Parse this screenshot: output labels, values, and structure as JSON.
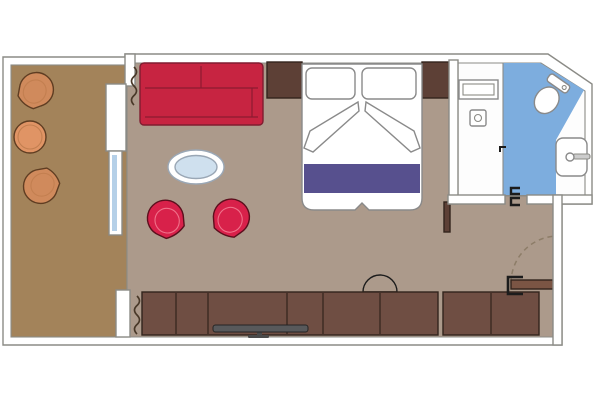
{
  "colors": {
    "background": "#ffffff",
    "wall_fill": "#ffffff",
    "wall_outline": "#8b8b86",
    "balcony_floor": "#a3835a",
    "cabin_floor": "#ac9a8b",
    "bathroom_floor_white": "#fdfdfd",
    "bathroom_floor_blue": "#7dadde",
    "glass_blue": "#b5d0e8",
    "sofa_red": "#c72441",
    "chair_red": "#d8214a",
    "stool_red": "#d8214a",
    "runner_purple": "#57508e",
    "wood_dark": "#5d4036",
    "wood_cabinet": "#6f4e43",
    "door_wood": "#7b5544",
    "balcony_chair_rim": "#d08a5c",
    "balcony_chair_seat": "#e7a377",
    "balcony_table": "#e09465",
    "oval_table_top": "#cfe0ee",
    "tv_gray": "#58595b",
    "tv_stand_gray": "#4a4a4a",
    "fixture_white": "#ffffff",
    "bracket_black": "#1c1c1c"
  },
  "scene": {
    "type": "cabin-floor-plan",
    "rooms": [
      {
        "name": "balcony",
        "items": [
          "tub-armchair",
          "tub-armchair",
          "round-table"
        ]
      },
      {
        "name": "living-area",
        "items": [
          "sofa",
          "oval-coffee-table",
          "swivel-chair",
          "swivel-chair",
          "tv-cabinet",
          "tv",
          "stool",
          "curtain",
          "curtain",
          "sliding-glass-door"
        ]
      },
      {
        "name": "sleeping-area",
        "items": [
          "double-bed",
          "pillow",
          "pillow",
          "folded-sheets",
          "bed-runner",
          "nightstand",
          "nightstand"
        ]
      },
      {
        "name": "bathroom",
        "items": [
          "vanity-counter",
          "shower-control",
          "toilet",
          "washbasin",
          "bathroom-door"
        ]
      },
      {
        "name": "entry",
        "items": [
          "entrance-door",
          "door-swing-arc",
          "wardrobe",
          "wall-stub"
        ]
      }
    ]
  }
}
